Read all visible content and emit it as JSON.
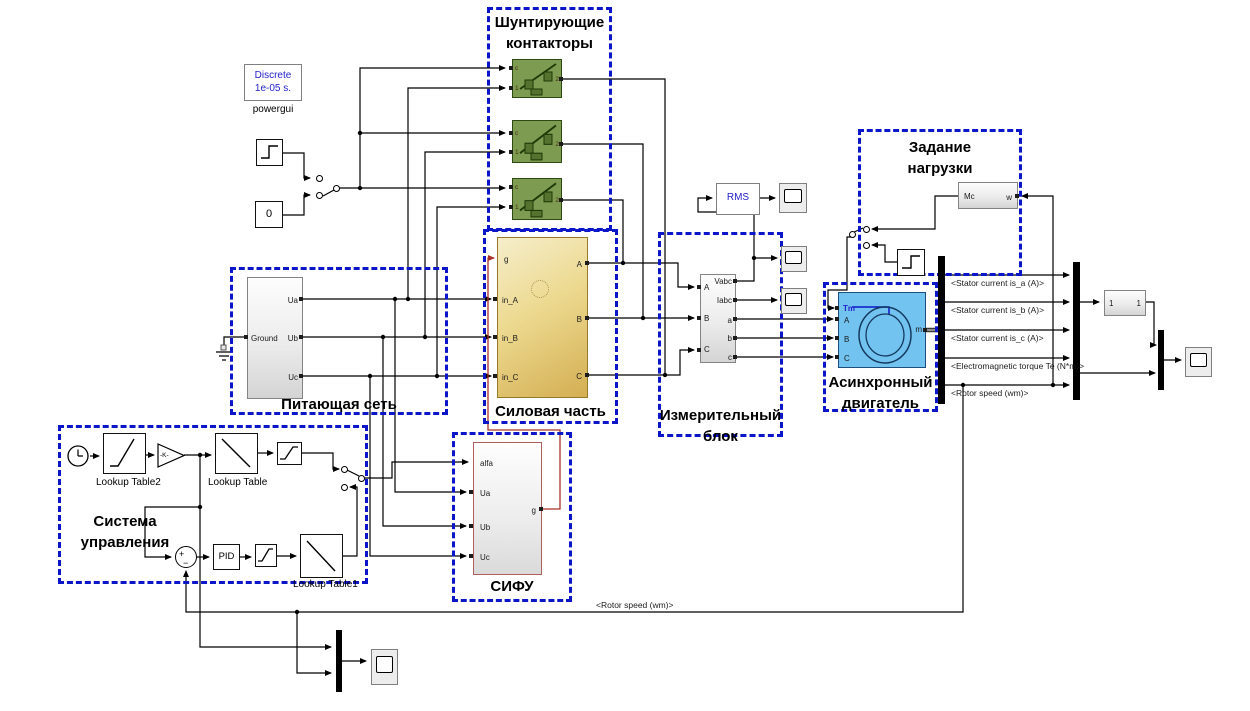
{
  "colors": {
    "annotation-blue": "#0b16c9",
    "breaker-green": "#7d9c52",
    "power-yellow": "#e8d489",
    "motor-blue": "#72c3f0",
    "gate-wire-red": "#a93226",
    "blue-text": "#2222cc"
  },
  "powergui": {
    "line1": "Discrete",
    "line2": "1e-05 s.",
    "label": "powergui"
  },
  "sources": {
    "const_zero": "0"
  },
  "annotations": {
    "shunt_line1": "Шунтирующие",
    "shunt_line2": "контакторы",
    "supply_title": "Питающая сеть",
    "power_title": "Силовая часть",
    "meas_line1": "Измерительный",
    "meas_line2": "блок",
    "load_line1": "Задание",
    "load_line2": "нагрузки",
    "motor_line1": "Асинхронный",
    "motor_line2": "двигатель",
    "control_line1": "Система",
    "control_line2": "управления",
    "sifu_title": "СИФУ"
  },
  "breaker": {
    "c": "c",
    "in": "1",
    "out": "2"
  },
  "supply": {
    "ground": "Ground",
    "ua": "Ua",
    "ub": "Ub",
    "uc": "Uc"
  },
  "power": {
    "g": "g",
    "in_a": "in_A",
    "in_b": "in_B",
    "in_c": "in_C",
    "a": "A",
    "b": "B",
    "c": "C"
  },
  "meas": {
    "a_in": "A",
    "b_in": "B",
    "c_in": "C",
    "vabc": "Vabc",
    "iabc": "Iabc",
    "a": "a",
    "b": "b",
    "c": "c"
  },
  "rms": {
    "label": "RMS"
  },
  "load": {
    "mc": "Mc",
    "w": "w"
  },
  "motor": {
    "tm": "Tm",
    "a": "A",
    "b": "B",
    "c": "C",
    "m": "m"
  },
  "sifu": {
    "alfa": "alfa",
    "ua": "Ua",
    "ub": "Ub",
    "uc": "Uc",
    "g": "g"
  },
  "control": {
    "pid": "PID",
    "gain": "-K-",
    "lookup_table": "Lookup Table",
    "lookup_table1": "Lookup Table1",
    "lookup_table2": "Lookup Table2",
    "sum_plus": "+",
    "sum_minus": "−"
  },
  "unity": {
    "in": "1",
    "out": "1"
  },
  "bus_labels": {
    "stator_a": "<Stator current is_a (A)>",
    "stator_b": "<Stator current is_b (A)>",
    "stator_c": "<Stator current is_c (A)>",
    "torque": "<Electromagnetic torque Te (N*m)>",
    "rotor_speed": "<Rotor speed (wm)>",
    "rotor_speed_feedback": "<Rotor speed (wm)>"
  }
}
